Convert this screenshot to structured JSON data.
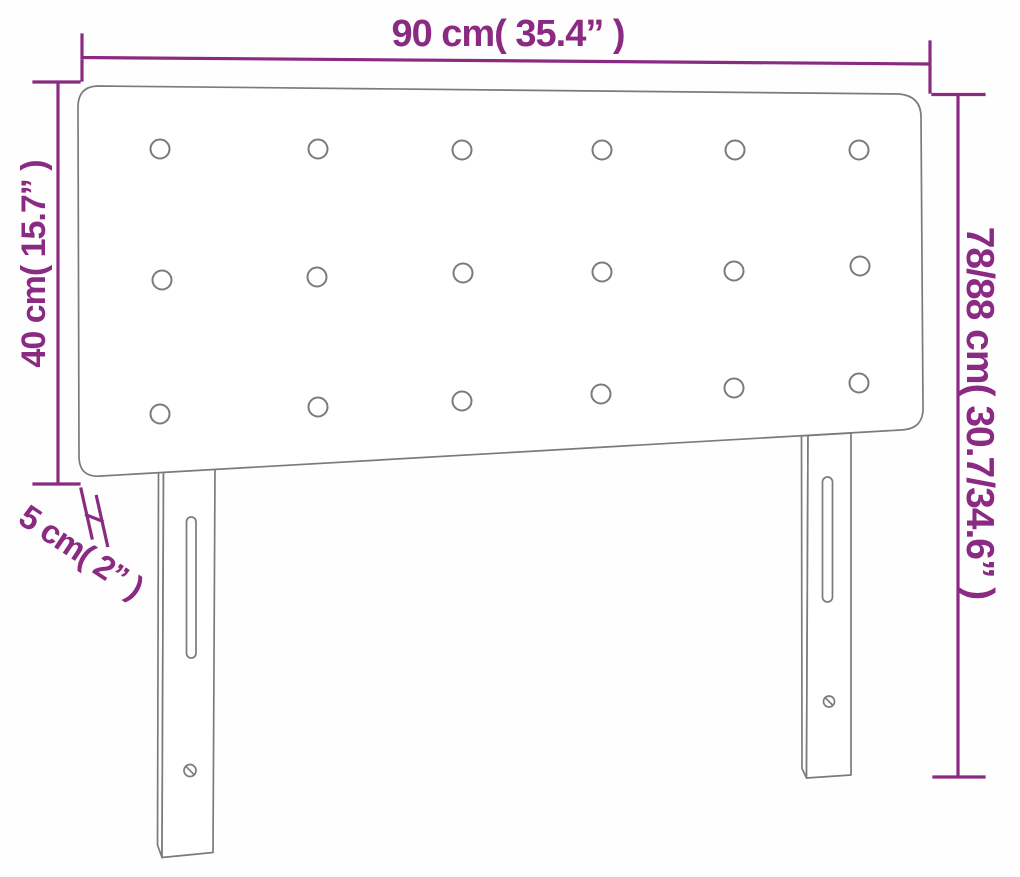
{
  "diagram": {
    "subject": "headboard-dimension-diagram",
    "labels": {
      "width": "90 cm( 35.4” )",
      "panel_height": "40 cm( 15.7” )",
      "total_height": "78/88 cm( 30.7/34.6” )",
      "thickness": "5 cm( 2” )"
    },
    "values": {
      "width_cm": "90",
      "width_in": "35.4",
      "panel_height_cm": "40",
      "panel_height_in": "15.7",
      "total_height_cm": "78/88",
      "total_height_in": "30.7/34.6",
      "thickness_cm": "5",
      "thickness_in": "2"
    },
    "buttons": {
      "rows": 3,
      "columns": 6
    }
  },
  "colors": {
    "dimension": "#8b2a82",
    "outline": "#7b7b7b",
    "background": "#fefefe"
  }
}
